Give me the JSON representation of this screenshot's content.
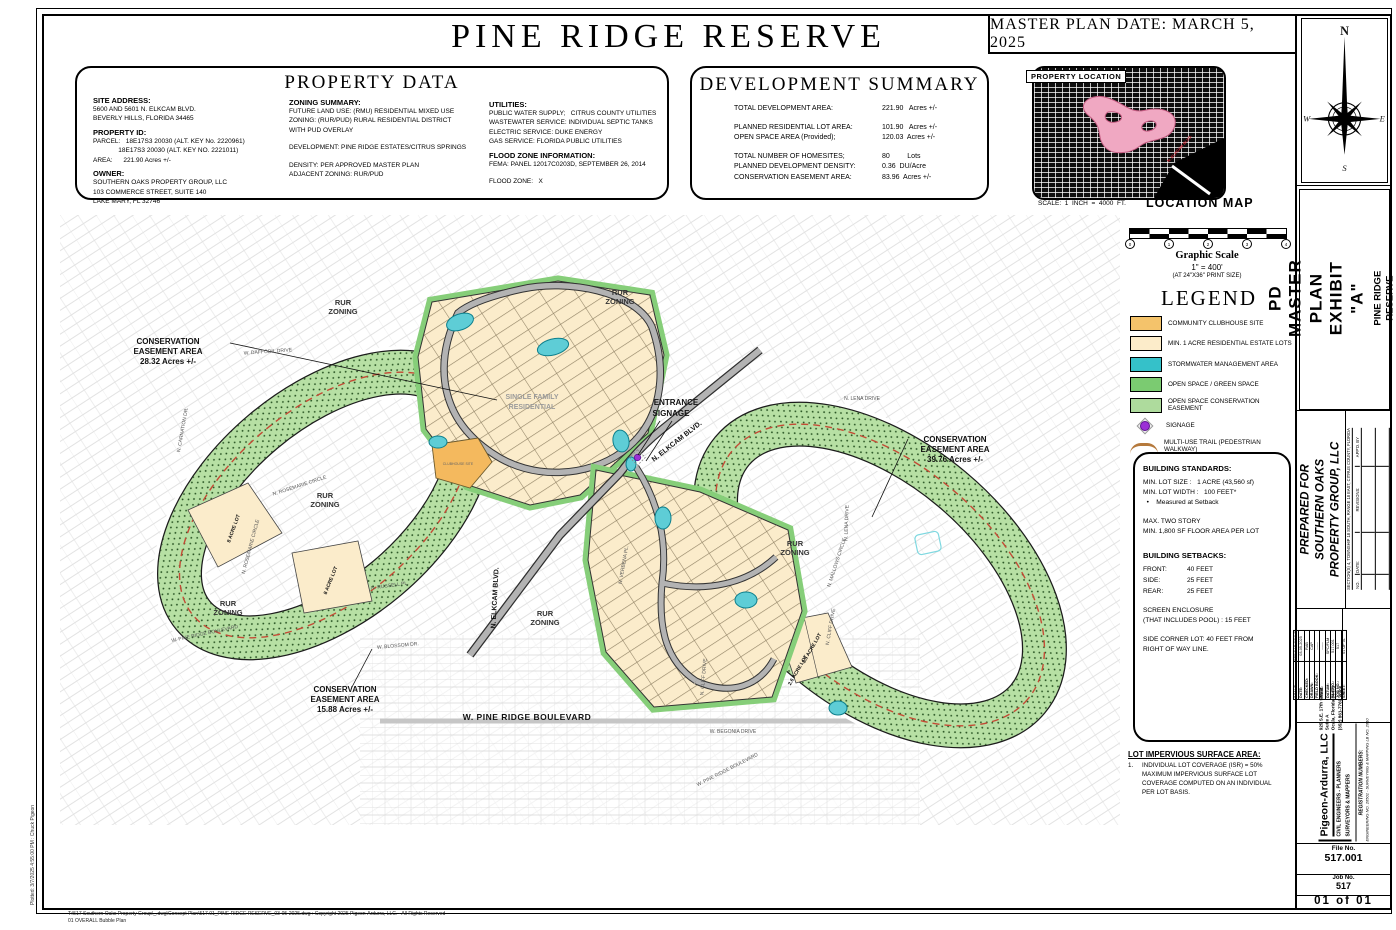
{
  "sheet": {
    "title": "PINE RIDGE RESERVE",
    "master_plan_date": "MASTER PLAN DATE: MARCH 5, 2025",
    "plotted_note": "Plotted: 3/7/2025 4:55:00 PM : Chuck Pigeon",
    "footer_line1": "T:\\517 Southern Oaks Property Group\\_.dwg\\Concept Plan\\517.01_PINE RIDGE RESERVE_03-05-2025.dwg : Copyright 2025 Pigeon-Ardurra, LLC. - All Rights Reserved",
    "footer_line2": "01 OVERALL Bubble Plan"
  },
  "property_data": {
    "title": "PROPERTY DATA",
    "site_address_label": "SITE ADDRESS:",
    "site_address_lines": [
      "5600 AND 5601 N. ELKCAM BLVD.",
      "BEVERLY HILLS, FLORIDA 34465"
    ],
    "property_id_label": "PROPERTY ID:",
    "property_id_lines": [
      "PARCEL:   18E17S3 20030 (ALT. KEY No. 2220961)",
      "              18E17S3 20030 (ALT. KEY NO. 2221011)",
      "AREA:      221.90 Acres +/-"
    ],
    "owner_label": "OWNER:",
    "owner_lines": [
      "SOUTHERN OAKS PROPERTY GROUP, LLC",
      "103 COMMERCE STREET, SUITE 140",
      "LAKE MARY, FL 32746"
    ],
    "zoning_label": "ZONING SUMMARY:",
    "zoning_lines": [
      "FUTURE LAND USE: (RMU) RESIDENTIAL MIXED USE",
      "ZONING: (RUR/PUD) RURAL RESIDENTIAL DISTRICT",
      "WITH PUD OVERLAY",
      "",
      "DEVELOPMENT: PINE RIDGE ESTATES/CITRUS SPRINGS",
      "",
      "DENSITY: PER APPROVED MASTER PLAN",
      "ADJACENT ZONING: RUR/PUD"
    ],
    "utilities_label": "UTILITIES:",
    "utilities_lines": [
      "PUBLIC WATER SUPPLY;   CITRUS COUNTY UTILITIES",
      "WASTEWATER SERVICE: INDIVIDUAL SEPTIC TANKS",
      "ELECTRIC SERVICE: DUKE ENERGY",
      "GAS SERVICE: FLORIDA PUBLIC UTILITIES"
    ],
    "flood_label": "FLOOD ZONE INFORMATION:",
    "flood_lines": [
      "FEMA: PANEL 12017C0203D, SEPTEMBER 26, 2014",
      "",
      "FLOOD ZONE:   X"
    ]
  },
  "development_summary": {
    "title": "DEVELOPMENT SUMMARY",
    "rows": [
      {
        "label": "TOTAL DEVELOPMENT AREA:",
        "value": "221.90   Acres +/-",
        "gap": false
      },
      {
        "label": "PLANNED RESIDENTIAL LOT AREA:",
        "value": "101.90   Acres +/-",
        "gap": true
      },
      {
        "label": "OPEN SPACE AREA (Provided);",
        "value": "120.03  Acres +/-",
        "gap": false
      },
      {
        "label": "TOTAL NUMBER OF HOMESITES;",
        "value": "80         Lots",
        "gap": true
      },
      {
        "label": "PLANNED DEVELOPMENT DENSITY:",
        "value": "0.36  DU/Acre",
        "gap": false
      },
      {
        "label": "CONSERVATION EASEMENT AREA:",
        "value": "83.96  Acres +/-",
        "gap": false
      }
    ]
  },
  "location_map": {
    "property_location_label": "PROPERTY LOCATION",
    "scale_note": "SCALE:  1  INCH  =  4000  FT.",
    "caption": "LOCATION MAP",
    "red_road_label": "N. ELKCAM BLVD.",
    "highlight_color": "#f0a8c2"
  },
  "graphic_scale": {
    "title": "Graphic Scale",
    "ratio": "1\"  =  400'",
    "note": "(AT 24\"X36\" PRINT SIZE)",
    "ticks": [
      "0",
      "1",
      "2",
      "3",
      "4"
    ]
  },
  "legend": {
    "title": "LEGEND",
    "items": [
      {
        "type": "color",
        "color": "#f4c36b",
        "label": "COMMUNITY CLUBHOUSE SITE"
      },
      {
        "type": "color",
        "color": "#fcecca",
        "label": "MIN. 1 ACRE RESIDENTIAL ESTATE LOTS"
      },
      {
        "type": "color",
        "color": "#35c1c9",
        "label": "STORMWATER MANAGEMENT AREA"
      },
      {
        "type": "color",
        "color": "#7bcb71",
        "label": "OPEN SPACE / GREEN SPACE"
      },
      {
        "type": "color",
        "color": "#aedb9d",
        "dotted": true,
        "label": "OPEN SPACE CONSERVATION EASEMENT"
      },
      {
        "type": "signage",
        "color": "#9b30d6",
        "label": "SIGNAGE"
      },
      {
        "type": "trail",
        "color": "#b5793c",
        "label": "MULTI-USE TRAIL (PEDESTRIAN WALKWAY)"
      }
    ]
  },
  "building_standards": {
    "title": "BUILDING STANDARDS:",
    "lines": [
      "MIN. LOT SIZE :   1 ACRE (43,560 sf)",
      "MIN. LOT WIDTH :   100 FEET*",
      "  •    Measured at Setback",
      "",
      "MAX. TWO STORY",
      "MIN. 1,800 SF FLOOR AREA PER LOT",
      ""
    ],
    "setbacks_title": "BUILDING SETBACKS:",
    "setbacks": [
      {
        "label": "FRONT:",
        "value": "40  FEET"
      },
      {
        "label": "SIDE:",
        "value": "25  FEET"
      },
      {
        "label": "REAR:",
        "value": "25  FEET"
      }
    ],
    "screen_lines": [
      "",
      "SCREEN ENCLOSURE",
      "(THAT INCLUDES POOL) : 15 FEET",
      "",
      "SIDE CORNER LOT: 40 FEET FROM",
      "RIGHT OF WAY LINE."
    ]
  },
  "impervious": {
    "title": "LOT IMPERVIOUS SURFACE AREA:",
    "item_no": "1.",
    "lines": [
      "INDIVIDUAL LOT COVERAGE (ISR) = 50%",
      "MAXIMUM IMPERVIOUS SURFACE LOT",
      "COVERAGE COMPUTED ON AN INDIVIDUAL",
      "PER LOT BASIS."
    ]
  },
  "titleblock": {
    "compass": {
      "n": "N",
      "e": "E",
      "s": "S",
      "w": "W"
    },
    "exhibit_line1": "PD MASTER PLAN",
    "exhibit_line2": "EXHIBIT \"A\"",
    "project_line1": "PINE RIDGE RESERVE",
    "project_line2": "CITRUS COUNTY, FLORIDA",
    "prepared_line1": "PREPARED FOR",
    "prepared_line2": "SOUTHERN OAKS",
    "prepared_line3": "PROPERTY GROUP, LLC",
    "section_line": "SECTION(S) 4, TOWNSHIP 18 SOUTH, RANGE 18 EAST, CITRUS COUNTY, FLORIDA",
    "rev_no": "NO.",
    "rev_date": "DATE:",
    "rev_revisions": "REVISIONS:",
    "rev_appd": "APP'D. BY",
    "fields": [
      {
        "label": "SCALE:",
        "value": "SEE BAR SCALE"
      },
      {
        "label": "DATE:",
        "value": "03-05-2025"
      },
      {
        "label": "CHECKED:",
        "value": "RAB"
      },
      {
        "label": "DRAWN:",
        "value": "CAP"
      },
      {
        "label": "FIELD BOOK:",
        "value": "------"
      },
      {
        "label": "PAGE:",
        "value": "------"
      },
      {
        "label": "DATUM:",
        "value": "SPC/FLM"
      },
      {
        "label": "FILE NO.:",
        "value": "517.001"
      },
      {
        "label": "JOB NO.:",
        "value": "517"
      },
      {
        "label": "SHEET:",
        "value": "01 OF 01"
      }
    ]
  },
  "firm": {
    "name": "Pigeon-Ardurra, LLC",
    "tagline1": "CIVIL ENGINEERS - PLANNERS",
    "tagline2": "SURVEYORS & MAPPERS",
    "address_lines": [
      "925 S.E. 17th Street",
      "Suite A",
      "Ocala, Florida 34471",
      "(352) 861-7769 voice"
    ],
    "reg_title": "REGISTRATION NUMBERS:",
    "reg_line": "ENGINEERING NO. 26501 - SURVEYING & MAPPING LB NO. 2610",
    "file_no_label": "File No.",
    "file_no": "517.001",
    "job_no_label": "Job No.",
    "job_no": "517",
    "sheet_no": "01 of 01"
  },
  "map": {
    "labels": [
      {
        "text": "CONSERVATION",
        "x": 108,
        "y": 129,
        "cls": "callout"
      },
      {
        "text": "EASEMENT AREA",
        "x": 108,
        "y": 139,
        "cls": "callout"
      },
      {
        "text": "28.32 Acres +/-",
        "x": 108,
        "y": 149,
        "cls": "callout"
      },
      {
        "text": "CONSERVATION",
        "x": 895,
        "y": 227,
        "cls": "callout"
      },
      {
        "text": "EASEMENT AREA",
        "x": 895,
        "y": 237,
        "cls": "callout"
      },
      {
        "text": "39.76 Acres +/-",
        "x": 895,
        "y": 247,
        "cls": "callout"
      },
      {
        "text": "CONSERVATION",
        "x": 285,
        "y": 477,
        "cls": "callout"
      },
      {
        "text": "EASEMENT AREA",
        "x": 285,
        "y": 487,
        "cls": "callout"
      },
      {
        "text": "15.88 Acres +/-",
        "x": 285,
        "y": 497,
        "cls": "callout"
      },
      {
        "text": "ENTRANCE",
        "x": 616,
        "y": 190,
        "cls": "callout"
      },
      {
        "text": "SIGNAGE",
        "x": 611,
        "y": 201,
        "cls": "callout"
      },
      {
        "text": "RUR",
        "x": 283,
        "y": 90,
        "cls": "zone"
      },
      {
        "text": "ZONING",
        "x": 283,
        "y": 99,
        "cls": "zone"
      },
      {
        "text": "RUR",
        "x": 560,
        "y": 80,
        "cls": "zone"
      },
      {
        "text": "ZONING",
        "x": 560,
        "y": 89,
        "cls": "zone"
      },
      {
        "text": "RUR",
        "x": 265,
        "y": 283,
        "cls": "zone"
      },
      {
        "text": "ZONING",
        "x": 265,
        "y": 292,
        "cls": "zone"
      },
      {
        "text": "RUR",
        "x": 168,
        "y": 391,
        "cls": "zone"
      },
      {
        "text": "ZONING",
        "x": 168,
        "y": 400,
        "cls": "zone"
      },
      {
        "text": "RUR",
        "x": 485,
        "y": 401,
        "cls": "zone"
      },
      {
        "text": "ZONING",
        "x": 485,
        "y": 410,
        "cls": "zone"
      },
      {
        "text": "RUR",
        "x": 735,
        "y": 331,
        "cls": "zone"
      },
      {
        "text": "ZONING",
        "x": 735,
        "y": 340,
        "cls": "zone"
      },
      {
        "text": "SINGLE FAMILY",
        "x": 472,
        "y": 184,
        "cls": "gray"
      },
      {
        "text": "RESIDENTIAL",
        "x": 472,
        "y": 194,
        "cls": "gray"
      },
      {
        "text": "N. ELKCAM BLVD.",
        "x": 618,
        "y": 228,
        "rot": -38,
        "cls": "road"
      },
      {
        "text": "N. ELKCAM BLVD.",
        "x": 437,
        "y": 383,
        "rot": -87,
        "cls": "road"
      },
      {
        "text": "W. PINE RIDGE BOULEVARD",
        "x": 467,
        "y": 505,
        "cls": "big"
      },
      {
        "text": "W. PINE RIDGE BOULEVARD",
        "x": 668,
        "y": 556,
        "rot": -27,
        "cls": "roadsm"
      },
      {
        "text": "W. PINE RIDGE BOULEVARD",
        "x": 145,
        "y": 420,
        "rot": -12,
        "cls": "roadsm"
      },
      {
        "text": "W. DAFFODIL DRIVE",
        "x": 208,
        "y": 138,
        "rot": -4,
        "cls": "roadsm"
      },
      {
        "text": "N. LENA DRIVE",
        "x": 802,
        "y": 185,
        "cls": "roadsm"
      },
      {
        "text": "N. LENA DRIVE",
        "x": 788,
        "y": 308,
        "rot": -88,
        "cls": "roadsm"
      },
      {
        "text": "N. MALLOWS CIRCLE",
        "x": 778,
        "y": 348,
        "rot": -72,
        "cls": "roadsm"
      },
      {
        "text": "N. CLIFF DRIVE",
        "x": 772,
        "y": 412,
        "rot": -80,
        "cls": "roadsm"
      },
      {
        "text": "N. CLIFF DRIVE",
        "x": 645,
        "y": 462,
        "rot": -85,
        "cls": "roadsm"
      },
      {
        "text": "W. BEGONIA DRIVE",
        "x": 673,
        "y": 518,
        "cls": "roadsm"
      },
      {
        "text": "W. BLOSSOM DR.",
        "x": 338,
        "y": 432,
        "rot": -5,
        "cls": "roadsm"
      },
      {
        "text": "N. CARNATION DR.",
        "x": 124,
        "y": 215,
        "rot": -80,
        "cls": "roadsm"
      },
      {
        "text": "N. ROSEMARIE CIRCLE",
        "x": 240,
        "y": 272,
        "rot": -18,
        "cls": "roadsm"
      },
      {
        "text": "N. ROSEMARIE CIRCLE",
        "x": 192,
        "y": 332,
        "rot": -75,
        "cls": "roadsm"
      },
      {
        "text": "N. VERBENA PL.",
        "x": 565,
        "y": 350,
        "rot": -80,
        "cls": "roadsm"
      },
      {
        "text": "N. RUSSELL PL.",
        "x": 330,
        "y": 372,
        "rot": -8,
        "cls": "roadsm"
      },
      {
        "text": "8 ACRE LOT",
        "x": 175,
        "y": 314,
        "rot": -70,
        "cls": "lot"
      },
      {
        "text": "8 ACRE LOT",
        "x": 272,
        "y": 366,
        "rot": -68,
        "cls": "lot"
      },
      {
        "text": "3.5 ACRE LOT",
        "x": 753,
        "y": 434,
        "rot": -60,
        "cls": "lot"
      },
      {
        "text": "2.6 ACRE LOT",
        "x": 739,
        "y": 456,
        "rot": -60,
        "cls": "lot"
      },
      {
        "text": "CLUBHOUSE SITE",
        "x": 398,
        "y": 250,
        "cls": "tiny"
      }
    ]
  }
}
